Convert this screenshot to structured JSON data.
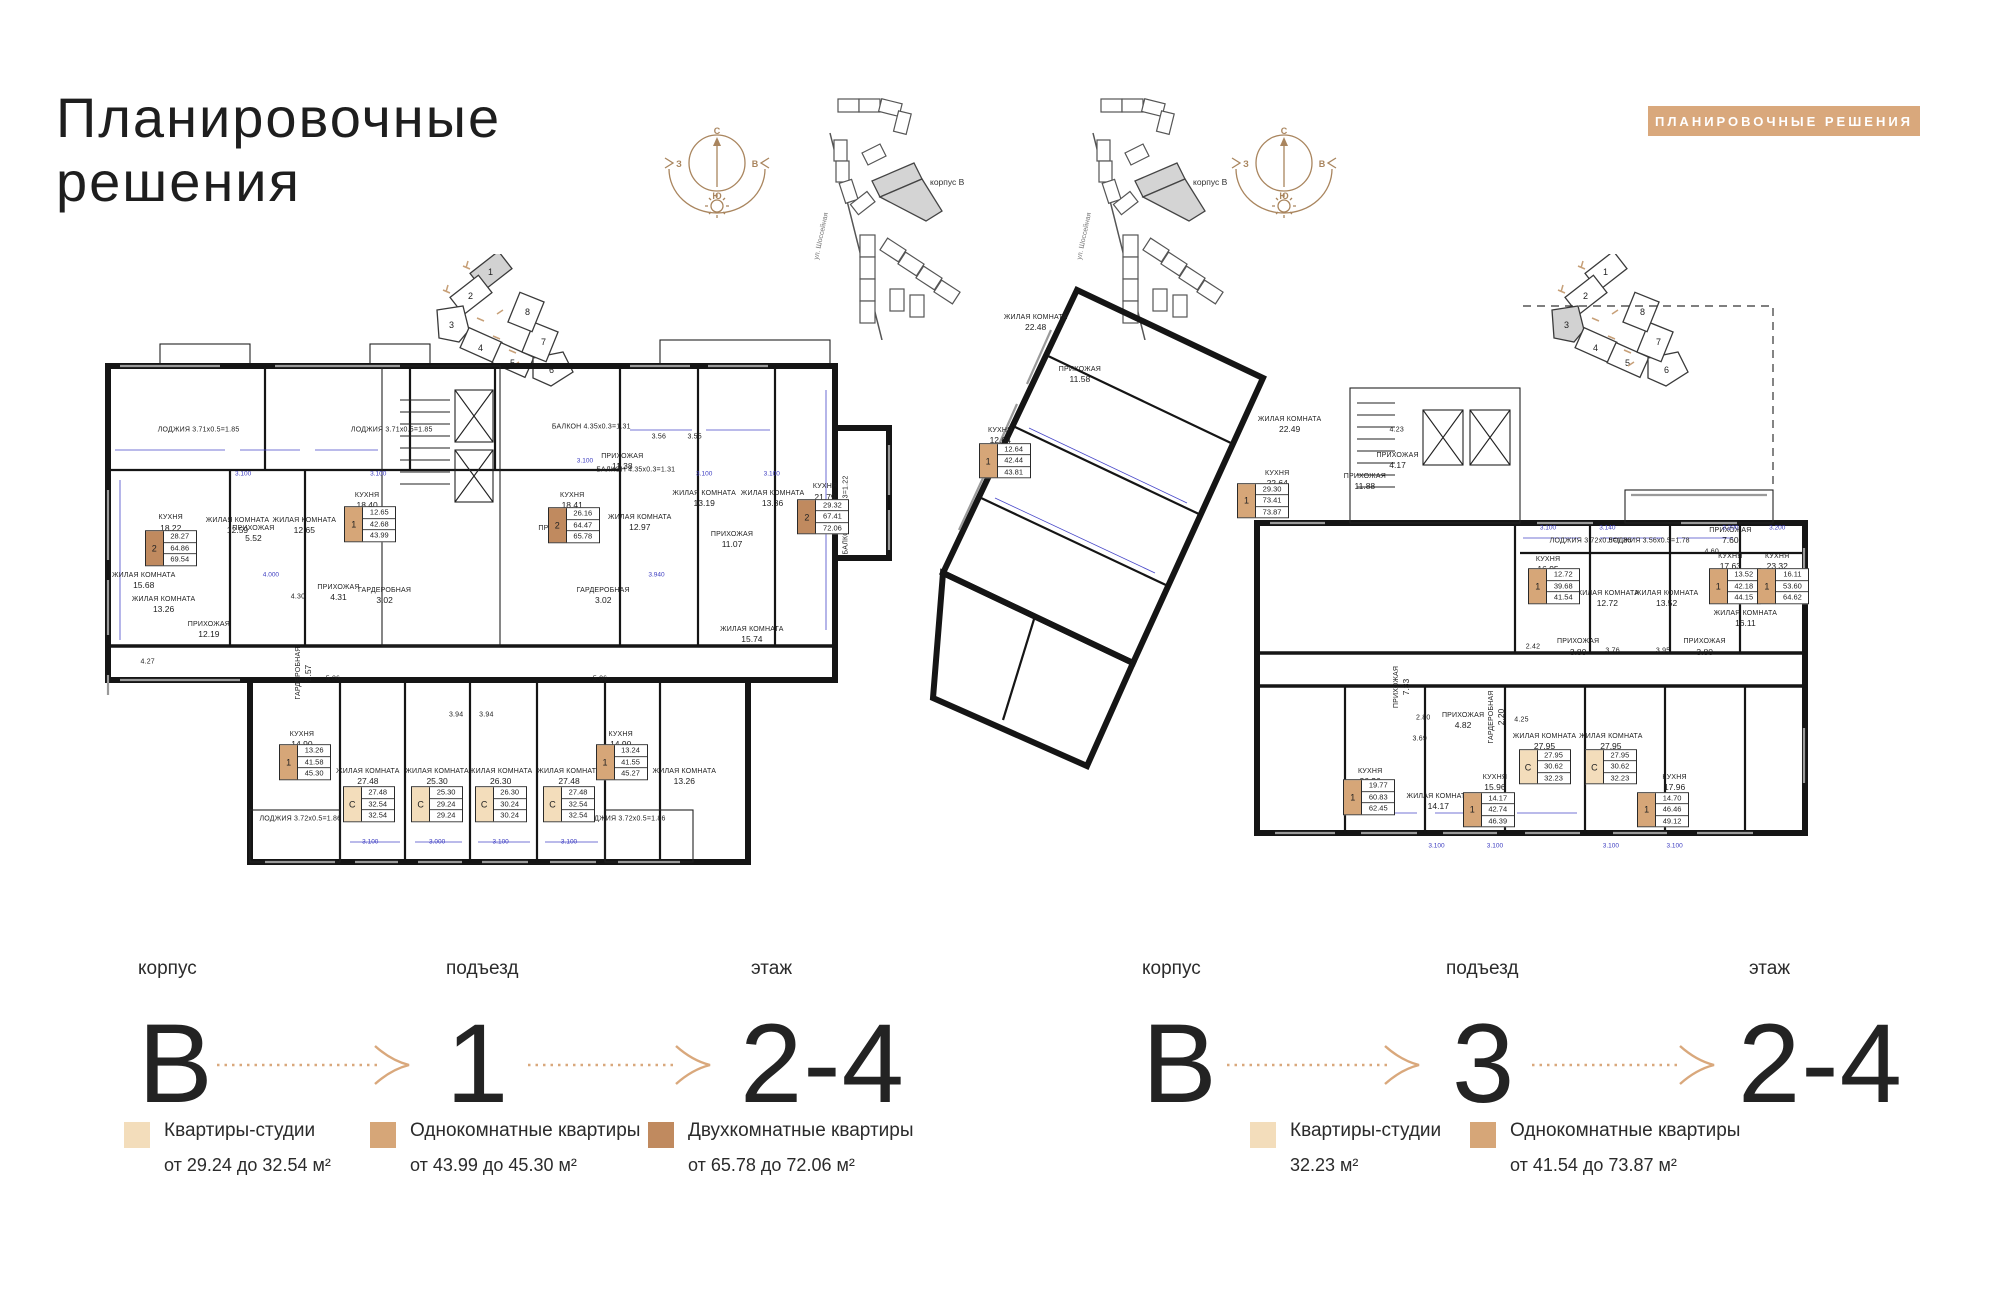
{
  "colors": {
    "accent": "#D9A87C",
    "studio": "#F3DDBB",
    "one_room": "#D6A678",
    "two_room": "#C08A5F",
    "wall": "#151515",
    "dim_line": "#4646C8"
  },
  "header": {
    "title_line1": "Планировочные",
    "title_line2": "решения",
    "badge": "ПЛАНИРОВОЧНЫЕ РЕШЕНИЯ"
  },
  "compass": {
    "n": "С",
    "s": "Ю",
    "w": "З",
    "e": "В"
  },
  "site_map": {
    "building_label": "корпус В",
    "street_label": "ул. Шоссейная"
  },
  "section_indicator": {
    "numbers": [
      "1",
      "2",
      "3",
      "4",
      "5",
      "6",
      "7",
      "8"
    ]
  },
  "plans": [
    {
      "id": "left",
      "highlighted_section": "1",
      "rooms": [
        {
          "t": "ЛОДЖИЯ 3.71х0.5=1.85",
          "x": 12.4,
          "y": 18.3
        },
        {
          "t": "ЛОДЖИЯ 3.71х0.5=1.85",
          "x": 36.7,
          "y": 18.3
        },
        {
          "t": "БАЛКОН 4.35х0.3=1.31",
          "x": 61.8,
          "y": 17.8
        },
        {
          "t": "БАЛКОН 4.35х0.3=1.31",
          "x": 67.4,
          "y": 25.6
        },
        {
          "t": "КУХНЯ",
          "a": "18.22",
          "x": 8.9,
          "y": 35.5
        },
        {
          "t": "ЖИЛАЯ КОМНАТА",
          "a": "12.59",
          "x": 17.3,
          "y": 36
        },
        {
          "t": "ЖИЛАЯ КОМНАТА",
          "a": "12.65",
          "x": 25.7,
          "y": 36
        },
        {
          "t": "КУХНЯ",
          "a": "18.40",
          "x": 33.6,
          "y": 31.4
        },
        {
          "t": "КУХНЯ",
          "a": "18.41",
          "x": 59.4,
          "y": 31.4
        },
        {
          "t": "ЖИЛАЯ КОМНАТА",
          "a": "12.97",
          "x": 67.9,
          "y": 35.4
        },
        {
          "t": "ЖИЛАЯ КОМНАТА",
          "a": "13.19",
          "x": 76,
          "y": 31
        },
        {
          "t": "ЖИЛАЯ КОМНАТА",
          "a": "13.36",
          "x": 84.6,
          "y": 31
        },
        {
          "t": "КУХНЯ",
          "a": "21.79",
          "x": 91.2,
          "y": 29.8
        },
        {
          "t": "ПРИХОЖАЯ",
          "a": "12.19",
          "x": 13.7,
          "y": 55
        },
        {
          "t": "ПРИХОЖАЯ",
          "a": "4.31",
          "x": 30,
          "y": 48.2
        },
        {
          "t": "ГАРДЕРОБНАЯ",
          "a": "3.02",
          "x": 35.8,
          "y": 48.8
        },
        {
          "t": "ГАРДЕРОБНАЯ",
          "a": "3.02",
          "x": 63.3,
          "y": 48.8
        },
        {
          "t": "ПРИХОЖАЯ",
          "a": "11.38",
          "x": 65.7,
          "y": 24.2
        },
        {
          "t": "ПРИХОЖАЯ",
          "a": "11.07",
          "x": 79.5,
          "y": 38.5
        },
        {
          "t": "ЖИЛАЯ КОМНАТА",
          "a": "15.68",
          "x": 5.5,
          "y": 46
        },
        {
          "t": "ЖИЛАЯ КОМНАТА",
          "a": "13.26",
          "x": 8,
          "y": 50.5
        },
        {
          "t": "ПРИХОЖАЯ",
          "a": "5.52",
          "x": 19.3,
          "y": 37.5
        },
        {
          "t": "ПРИХОЖАЯ",
          "a": "5.56",
          "x": 57.8,
          "y": 37.5
        },
        {
          "t": "ГАРДЕРОБНАЯ",
          "a": "2.57",
          "x": 25.6,
          "y": 63,
          "vert": true
        },
        {
          "t": "5.06",
          "x": 29.3,
          "y": 64
        },
        {
          "t": "5.06",
          "x": 62.9,
          "y": 64
        },
        {
          "t": "4.30",
          "x": 24.9,
          "y": 48.9
        },
        {
          "t": "4.27",
          "x": 6,
          "y": 61
        },
        {
          "t": "3.56",
          "x": 70.3,
          "y": 19.7
        },
        {
          "t": "3.55",
          "x": 74.8,
          "y": 19.7
        },
        {
          "t": "3.94",
          "x": 44.8,
          "y": 70.6
        },
        {
          "t": "3.94",
          "x": 48.6,
          "y": 70.6
        },
        {
          "t": "КУХНЯ",
          "a": "14.90",
          "x": 25.4,
          "y": 75.2
        },
        {
          "t": "ЖИЛАЯ КОМНАТА",
          "a": "27.48",
          "x": 33.7,
          "y": 82
        },
        {
          "t": "ЖИЛАЯ КОМНАТА",
          "a": "25.30",
          "x": 42.4,
          "y": 82
        },
        {
          "t": "ЖИЛАЯ КОМНАТА",
          "a": "26.30",
          "x": 50.4,
          "y": 82
        },
        {
          "t": "ЖИЛАЯ КОМНАТА",
          "a": "27.48",
          "x": 59,
          "y": 82
        },
        {
          "t": "КУХНЯ",
          "a": "14.90",
          "x": 65.5,
          "y": 75.2
        },
        {
          "t": "ЖИЛАЯ КОМНАТА",
          "a": "13.26",
          "x": 73.5,
          "y": 82
        },
        {
          "t": "ЛОДЖИЯ 3.72х0.5=1.86",
          "x": 25.2,
          "y": 89.8
        },
        {
          "t": "ЛОДЖИЯ 3.72х0.5=1.86",
          "x": 66,
          "y": 89.8
        },
        {
          "t": "ЖИЛАЯ КОМНАТА",
          "a": "15.74",
          "x": 82,
          "y": 56
        },
        {
          "t": "БАЛКОН 4.07х0.3=1.22",
          "x": 93.8,
          "y": 34,
          "vert": true
        }
      ],
      "badges": [
        {
          "type": "2",
          "v": [
            "28.27",
            "64.86",
            "69.54"
          ],
          "x": 8.9,
          "y": 40
        },
        {
          "type": "1",
          "v": [
            "12.65",
            "42.68",
            "43.99"
          ],
          "x": 34,
          "y": 35.6
        },
        {
          "type": "2",
          "v": [
            "26.16",
            "64.47",
            "65.78"
          ],
          "x": 59.6,
          "y": 35.8
        },
        {
          "type": "2",
          "v": [
            "29.32",
            "67.41",
            "72.06"
          ],
          "x": 91,
          "y": 34.3
        },
        {
          "type": "1",
          "v": [
            "13.26",
            "41.58",
            "45.30"
          ],
          "x": 25.8,
          "y": 79.3
        },
        {
          "type": "С",
          "v": [
            "27.48",
            "32.54",
            "32.54"
          ],
          "x": 33.8,
          "y": 87
        },
        {
          "type": "С",
          "v": [
            "25.30",
            "29.24",
            "29.24"
          ],
          "x": 42.4,
          "y": 87
        },
        {
          "type": "С",
          "v": [
            "26.30",
            "30.24",
            "30.24"
          ],
          "x": 50.4,
          "y": 87
        },
        {
          "type": "С",
          "v": [
            "27.48",
            "32.54",
            "32.54"
          ],
          "x": 59,
          "y": 87
        },
        {
          "type": "1",
          "v": [
            "13.24",
            "41.55",
            "45.27"
          ],
          "x": 65.6,
          "y": 79.3
        }
      ],
      "dims": [
        {
          "t": "3.100",
          "x": 18,
          "y": 26.5
        },
        {
          "t": "3.100",
          "x": 35,
          "y": 26.5
        },
        {
          "t": "3.100",
          "x": 61,
          "y": 24
        },
        {
          "t": "3.100",
          "x": 76,
          "y": 26.5
        },
        {
          "t": "3.100",
          "x": 84.5,
          "y": 26.5
        },
        {
          "t": "3.100",
          "x": 34,
          "y": 94
        },
        {
          "t": "3.000",
          "x": 42.4,
          "y": 94
        },
        {
          "t": "3.100",
          "x": 50.4,
          "y": 94
        },
        {
          "t": "3.100",
          "x": 59,
          "y": 94
        },
        {
          "t": "4.000",
          "x": 21.5,
          "y": 45
        },
        {
          "t": "3.940",
          "x": 70,
          "y": 45
        }
      ]
    },
    {
      "id": "right",
      "highlighted_section": "3",
      "rooms": [
        {
          "t": "ЖИЛАЯ КОМНАТА",
          "a": "22.48",
          "x": 12.5,
          "y": 9
        },
        {
          "t": "ПРИХОЖАЯ",
          "a": "11.58",
          "x": 17.5,
          "y": 17.5
        },
        {
          "t": "КУХНЯ",
          "a": "12.64",
          "x": 8.5,
          "y": 27.5
        },
        {
          "t": "ЖИЛАЯ КОМНАТА",
          "a": "22.49",
          "x": 41.2,
          "y": 25.7
        },
        {
          "t": "КУХНЯ",
          "a": "22.64",
          "x": 39.8,
          "y": 34.5
        },
        {
          "t": "ПРИХОЖАЯ",
          "a": "11.88",
          "x": 49.7,
          "y": 34.9
        },
        {
          "t": "4.23",
          "x": 53.3,
          "y": 26.5
        },
        {
          "t": "ПРИХОЖАЯ",
          "a": "4.17",
          "x": 53.4,
          "y": 31.5
        },
        {
          "t": "КУХНЯ",
          "a": "16.95",
          "x": 70.4,
          "y": 48.5
        },
        {
          "t": "ЛОДЖИЯ 3.72х0.5=1.86",
          "x": 75.2,
          "y": 44.6
        },
        {
          "t": "ЛОДЖИЯ 3.56х0.5=1.78",
          "x": 81.8,
          "y": 44.6
        },
        {
          "t": "ЖИЛАЯ КОМНАТА",
          "a": "12.72",
          "x": 77.1,
          "y": 54.1
        },
        {
          "t": "ЖИЛАЯ КОМНАТА",
          "a": "13.52",
          "x": 83.8,
          "y": 54.1
        },
        {
          "t": "КУХНЯ",
          "a": "17.63",
          "x": 91,
          "y": 48
        },
        {
          "t": "КУХНЯ",
          "a": "23.32",
          "x": 96.3,
          "y": 48
        },
        {
          "t": "ПРИХОЖАЯ",
          "a": "7.33",
          "x": 53.9,
          "y": 68.5,
          "vert": true
        },
        {
          "t": "2.80",
          "x": 56.3,
          "y": 73.5
        },
        {
          "t": "3.69",
          "x": 55.9,
          "y": 77
        },
        {
          "t": "ПРИХОЖАЯ",
          "a": "4.82",
          "x": 60.8,
          "y": 74
        },
        {
          "t": "ГАРДЕРОБНАЯ",
          "a": "2.20",
          "x": 64.6,
          "y": 73.4,
          "vert": true
        },
        {
          "t": "4.25",
          "x": 67.4,
          "y": 73.8
        },
        {
          "t": "2.42",
          "x": 68.7,
          "y": 62
        },
        {
          "t": "ПРИХОЖАЯ",
          "a": "3.80",
          "x": 73.8,
          "y": 62
        },
        {
          "t": "3.76",
          "x": 77.7,
          "y": 62.6
        },
        {
          "t": "3.95",
          "x": 83.4,
          "y": 62.6
        },
        {
          "t": "ПРИХОЖАЯ",
          "a": "3.80",
          "x": 88.1,
          "y": 62
        },
        {
          "t": "КУХНЯ",
          "a": "26.26",
          "x": 50.3,
          "y": 83.1
        },
        {
          "t": "ЖИЛАЯ КОМНАТА",
          "a": "14.17",
          "x": 58,
          "y": 87.2
        },
        {
          "t": "КУХНЯ",
          "a": "15.96",
          "x": 64.4,
          "y": 84.1
        },
        {
          "t": "ЖИЛАЯ КОМНАТА",
          "a": "27.95",
          "x": 70,
          "y": 77.5
        },
        {
          "t": "ЖИЛАЯ КОМНАТА",
          "a": "27.95",
          "x": 77.5,
          "y": 77.5
        },
        {
          "t": "КУХНЯ",
          "a": "17.96",
          "x": 84.7,
          "y": 84.1
        },
        {
          "t": "ЖИЛАЯ КОМНАТА",
          "a": "16.11",
          "x": 92.7,
          "y": 57.4
        },
        {
          "t": "ПРИХОЖАЯ",
          "a": "7.60",
          "x": 91,
          "y": 43.8
        },
        {
          "t": "4.60",
          "x": 88.9,
          "y": 46.4
        }
      ],
      "badges": [
        {
          "type": "1",
          "v": [
            "12.64",
            "42.44",
            "43.81"
          ],
          "x": 9,
          "y": 31.5
        },
        {
          "type": "1",
          "v": [
            "29.30",
            "73.41",
            "73.87"
          ],
          "x": 38.2,
          "y": 38
        },
        {
          "type": "1",
          "v": [
            "12.72",
            "39.68",
            "41.54"
          ],
          "x": 71.1,
          "y": 52
        },
        {
          "type": "1",
          "v": [
            "13.52",
            "42.18",
            "44.15"
          ],
          "x": 91.5,
          "y": 52
        },
        {
          "type": "1",
          "v": [
            "16.11",
            "53.60",
            "64.62"
          ],
          "x": 97,
          "y": 52
        },
        {
          "type": "1",
          "v": [
            "19.77",
            "60.83",
            "62.45"
          ],
          "x": 50.2,
          "y": 86.5
        },
        {
          "type": "1",
          "v": [
            "14.17",
            "42.74",
            "46.39"
          ],
          "x": 63.7,
          "y": 88.5
        },
        {
          "type": "1",
          "v": [
            "14.70",
            "46.46",
            "49.12"
          ],
          "x": 83.4,
          "y": 88.5
        },
        {
          "type": "С",
          "v": [
            "27.95",
            "30.62",
            "32.23"
          ],
          "x": 70,
          "y": 81.5
        },
        {
          "type": "С",
          "v": [
            "27.95",
            "30.62",
            "32.23"
          ],
          "x": 77.5,
          "y": 81.5
        }
      ],
      "dims": [
        {
          "t": "3.100",
          "x": 70.4,
          "y": 42.5
        },
        {
          "t": "3.140",
          "x": 77.1,
          "y": 42.5
        },
        {
          "t": "3.200",
          "x": 91,
          "y": 42.5
        },
        {
          "t": "3.200",
          "x": 96.3,
          "y": 42.5
        },
        {
          "t": "3.100",
          "x": 57.8,
          "y": 94.5
        },
        {
          "t": "3.100",
          "x": 64.4,
          "y": 94.5
        },
        {
          "t": "3.100",
          "x": 77.5,
          "y": 94.5
        },
        {
          "t": "3.100",
          "x": 84.7,
          "y": 94.5
        }
      ]
    }
  ],
  "info_rows": [
    {
      "building_label": "корпус",
      "building": "В",
      "entrance_label": "подъезд",
      "entrance": "1",
      "floor_label": "этаж",
      "floor": "2-4"
    },
    {
      "building_label": "корпус",
      "building": "В",
      "entrance_label": "подъезд",
      "entrance": "3",
      "floor_label": "этаж",
      "floor": "2-4"
    }
  ],
  "legends": [
    {
      "items": [
        {
          "color": "studio",
          "title": "Квартиры-студии",
          "range": "от 29.24 до 32.54 м²"
        },
        {
          "color": "one_room",
          "title": "Однокомнатные квартиры",
          "range": "от 43.99 до 45.30 м²"
        },
        {
          "color": "two_room",
          "title": "Двухкомнатные квартиры",
          "range": "от 65.78 до 72.06 м²"
        }
      ]
    },
    {
      "items": [
        {
          "color": "studio",
          "title": "Квартиры-студии",
          "range": "32.23 м²"
        },
        {
          "color": "one_room",
          "title": "Однокомнатные квартиры",
          "range": "от 41.54 до 73.87 м²"
        }
      ]
    }
  ]
}
